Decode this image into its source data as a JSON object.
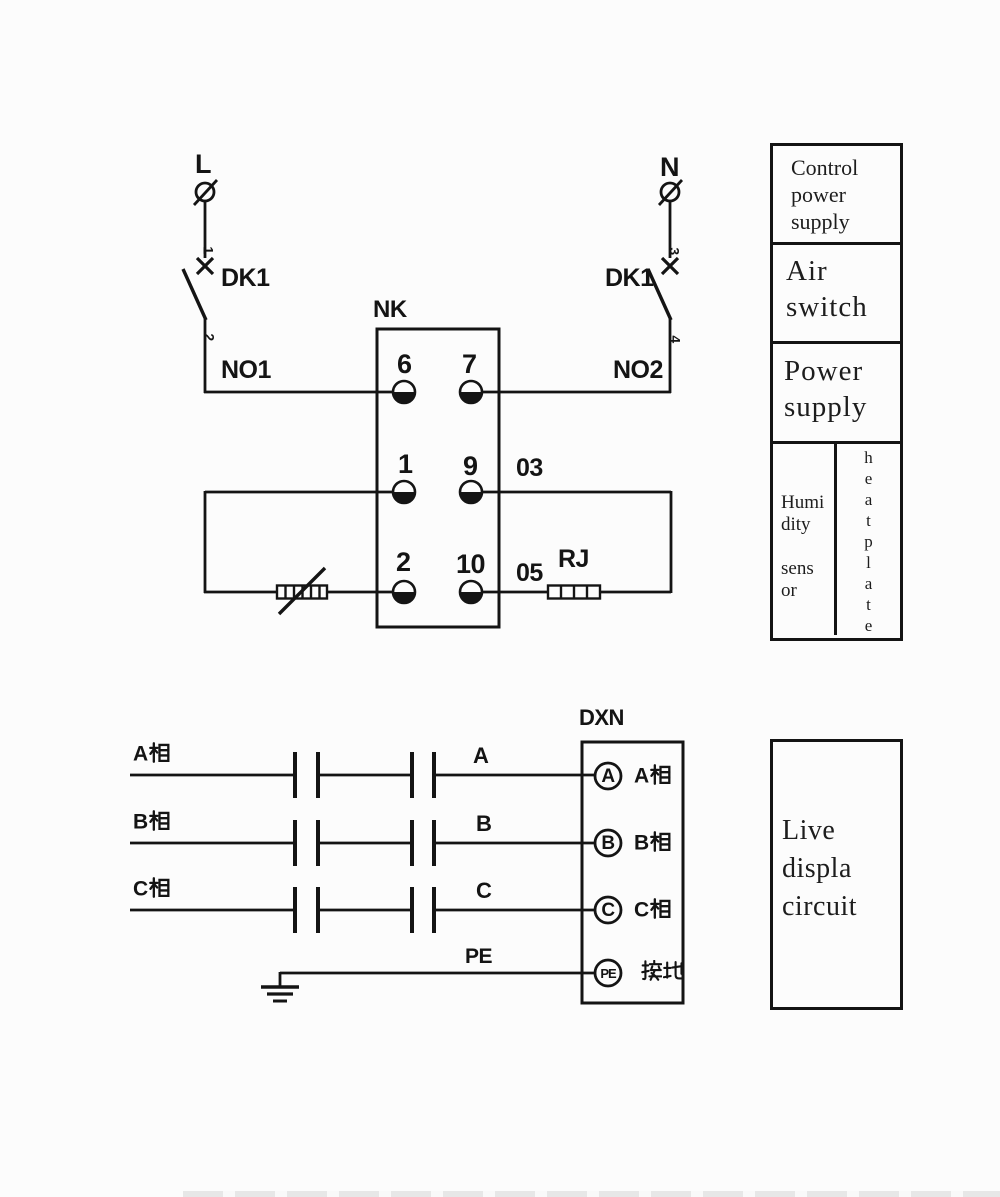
{
  "colors": {
    "ink": "#141414",
    "background": "#fcfcfc"
  },
  "top_circuit": {
    "live": {
      "phase": "L",
      "pin_in": "1",
      "pin_out": "2",
      "breaker": "DK1",
      "node": "NO1"
    },
    "neutral": {
      "phase": "N",
      "pin_in": "3",
      "pin_out": "4",
      "breaker": "DK1",
      "node": "NO2"
    },
    "controller": {
      "name": "NK",
      "terminals": [
        "6",
        "7",
        "1",
        "9",
        "2",
        "10"
      ]
    },
    "wire_labels": {
      "terminal9": "03",
      "terminal10": "05"
    },
    "heater": "RJ"
  },
  "legend": {
    "sections": [
      {
        "label": "Control power supply",
        "lines": [
          "Control",
          "power",
          "supply"
        ]
      },
      {
        "label": "Air switch",
        "lines": [
          "Air",
          "switch"
        ]
      },
      {
        "label": "Power supply",
        "lines": [
          "Power",
          "supply"
        ]
      }
    ],
    "humidity_label": "Humidity sensor",
    "humidity_lines": [
      "Humi",
      "dity",
      "sens",
      "or"
    ],
    "heat_plate_label": "heatplate",
    "heat_plate_letters": [
      "h",
      "e",
      "a",
      "t",
      "p",
      "l",
      "a",
      "t",
      "e"
    ]
  },
  "live_display": {
    "label": "Live displa circuit",
    "lines": [
      "Live",
      "displa",
      "circuit"
    ]
  },
  "phase_circuit": {
    "unit": "DXN",
    "rows": [
      {
        "source": "A相",
        "wire": "A",
        "terminal": "A",
        "label": "A相"
      },
      {
        "source": "B相",
        "wire": "B",
        "terminal": "B",
        "label": "B相"
      },
      {
        "source": "C相",
        "wire": "C",
        "terminal": "C",
        "label": "C相"
      },
      {
        "source": "",
        "wire": "PE",
        "terminal": "PE",
        "label": "接地"
      }
    ]
  }
}
